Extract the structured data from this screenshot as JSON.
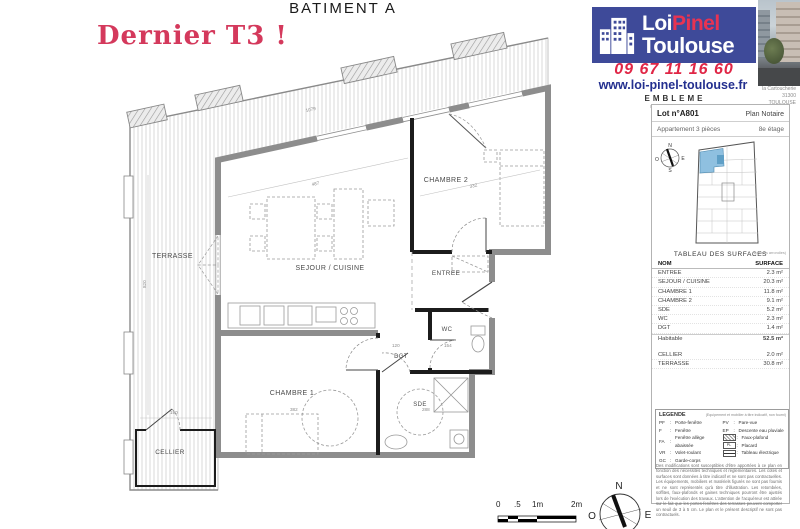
{
  "title": "BATIMENT A",
  "promo": "Dernier T3 !",
  "colors": {
    "banner_blue": "#3e4a99",
    "brand_red": "#e83352",
    "phone_red": "#e02646",
    "website_blue": "#232f8f",
    "promo_red": "#d4395c",
    "plan_highlight": "#8fc0e0"
  },
  "brand": {
    "line1_white": "Loi",
    "line1_red": "Pinel",
    "line2": "Toulouse",
    "phone": "09 67 11 16 60",
    "website": "www.loi-pinel-toulouse.fr"
  },
  "agency": {
    "name": "EMBLEME",
    "tagline": "promotion urbaine",
    "address_lines": [
      "la Cartoucherie",
      "31300",
      "TOULOUSE"
    ]
  },
  "lot": {
    "number": "Lot n°A801",
    "plan_type": "Plan Notaire",
    "apartment": "Appartement 3 pièces",
    "floor": "8e étage"
  },
  "surface_table": {
    "title": "TABLEAU DES SURFACES",
    "note": "(surfaces arrondies)",
    "headers": [
      "NOM",
      "SURFACE"
    ],
    "rows": [
      [
        "ENTREE",
        "2.3 m²"
      ],
      [
        "SEJOUR / CUISINE",
        "20.3 m²"
      ],
      [
        "CHAMBRE 1",
        "11.8 m²"
      ],
      [
        "CHAMBRE 2",
        "9.1 m²"
      ],
      [
        "SDE",
        "5.2 m²"
      ],
      [
        "WC",
        "2.3 m²"
      ],
      [
        "DGT",
        "1.4 m²"
      ]
    ],
    "total": [
      "Habitable",
      "52.5 m²"
    ],
    "annex_rows": [
      [
        "CELLIER",
        "2.0 m²"
      ],
      [
        "TERRASSE",
        "30.8 m²"
      ]
    ]
  },
  "legend": {
    "title": "LEGENDE",
    "note": "(Equipement et mobilier à titre indicatif, non fourni)",
    "items_left": [
      {
        "key": "PF",
        "label": "Porte-fenêtre"
      },
      {
        "key": "F",
        "label": "Fenêtre"
      },
      {
        "key": "FA",
        "label": "Fenêtre allège abaissée"
      },
      {
        "key": "VR",
        "label": "Volet-roulant"
      },
      {
        "key": "GC",
        "label": "Garde-corps"
      }
    ],
    "items_right": [
      {
        "key": "PV",
        "label": "Pare-vue"
      },
      {
        "key": "EP",
        "label": "Descente eau pluviale"
      },
      {
        "key": "",
        "label": "Faux-plafond"
      },
      {
        "key": "PL",
        "label": "Placard"
      },
      {
        "key": "",
        "label": "Tableau électrique"
      }
    ],
    "disclaimer": "Des modifications sont susceptibles d'être apportées à ce plan en fonction des nécessités techniques et réglementaires. Les cotes et surfaces sont données à titre indicatif et ne sont pas contractuelles. Les équipements, mobiliers et matériels figurés ne sont pas fournis et ne sont représentés qu'à titre d'illustration. Les retombées, soffites, faux-plafonds et gaines techniques pourront être ajustés lors de l'exécution des travaux. L'attention de l'acquéreur est attirée sur le fait que les portes-fenêtres des terrasses peuvent comporter un seuil de 3 à 5 cm. Le plan et le présent descriptif ne sont pas contractuels."
  },
  "plan": {
    "rooms": {
      "terrasse": "TERRASSE",
      "sejour": "SEJOUR / CUISINE",
      "chambre2": "CHAMBRE 2",
      "entree": "ENTREE",
      "wc": "WC",
      "dgt": "DGT",
      "chambre1": "CHAMBRE 1",
      "sde": "SDE",
      "cellier": "CELLIER"
    },
    "dims": {
      "top": "1079",
      "sejour_w": "487",
      "chambre2_w": "332",
      "left_h": "820",
      "cellier_w": "190",
      "chambre1_w": "382",
      "sde_w": "288",
      "dgt_w": "120",
      "wc_w": "154"
    }
  },
  "scale": {
    "labels": [
      "0",
      ".5",
      "1m",
      "2m"
    ]
  },
  "compass": {
    "n": "N",
    "e": "E",
    "o": "O",
    "s": "S"
  }
}
